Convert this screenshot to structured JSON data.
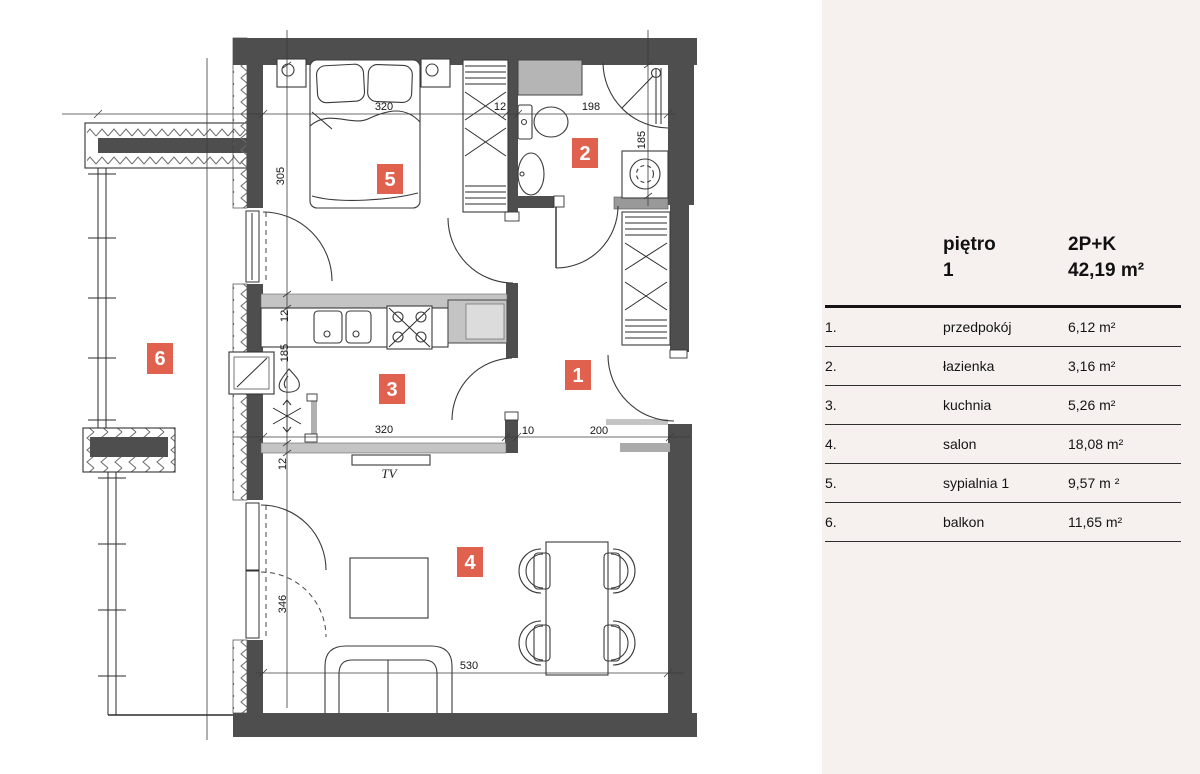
{
  "panel": {
    "header": {
      "floor_label": "piętro",
      "floor_number": "1",
      "layout_type": "2P+K",
      "total_area": "42,19 m²"
    },
    "rows": [
      {
        "num": "1.",
        "name": "przedpokój",
        "area": "6,12 m²"
      },
      {
        "num": "2.",
        "name": "łazienka",
        "area": "3,16 m²"
      },
      {
        "num": "3.",
        "name": "kuchnia",
        "area": "5,26 m²"
      },
      {
        "num": "4.",
        "name": "salon",
        "area": "18,08 m²"
      },
      {
        "num": "5.",
        "name": "sypialnia 1",
        "area": "9,57 m ²"
      },
      {
        "num": "6.",
        "name": "balkon",
        "area": "11,65 m²"
      }
    ]
  },
  "plan": {
    "rooms": {
      "hallway": "1",
      "bathroom": "2",
      "kitchen": "3",
      "living_room": "4",
      "bedroom": "5",
      "balcony": "6"
    },
    "dims": {
      "bedroom_width": "320",
      "top_wall": "12",
      "bathroom_width": "198",
      "bedroom_depth": "305",
      "bathroom_depth": "185",
      "kitchen_top_wall": "12",
      "kitchen_depth": "185",
      "tv_wall": "12",
      "living_depth": "346",
      "kitchen_width": "320",
      "hall_wall": "10",
      "hallway_width": "200",
      "living_width": "530"
    },
    "labels": {
      "tv": "TV"
    },
    "colors": {
      "wall_dark": "#4e4e4e",
      "wall_light": "#c4c4c4",
      "badge": "#e0614e",
      "panel_bg": "#f6f1ef"
    }
  }
}
